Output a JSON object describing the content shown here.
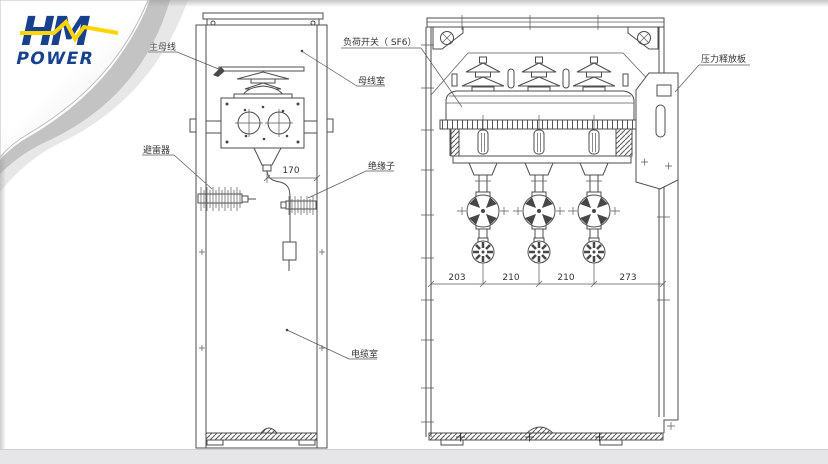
{
  "brand": {
    "word_top": "HM",
    "word_bottom": "POWER",
    "blue": "#17418f",
    "yellow": "#ffd400"
  },
  "drawing": {
    "side_view": {
      "labels": {
        "main_busbar": "主母线",
        "busbar_room": "母线室",
        "arrester": "避雷器",
        "insulator": "绝缘子",
        "cable_room": "电缆室"
      },
      "dimension_170": "170"
    },
    "front_view": {
      "labels": {
        "load_switch": "负荷开关（ SF6）",
        "pressure_relief": "压力释放板"
      },
      "dimensions": [
        "203",
        "210",
        "210",
        "273"
      ]
    }
  }
}
